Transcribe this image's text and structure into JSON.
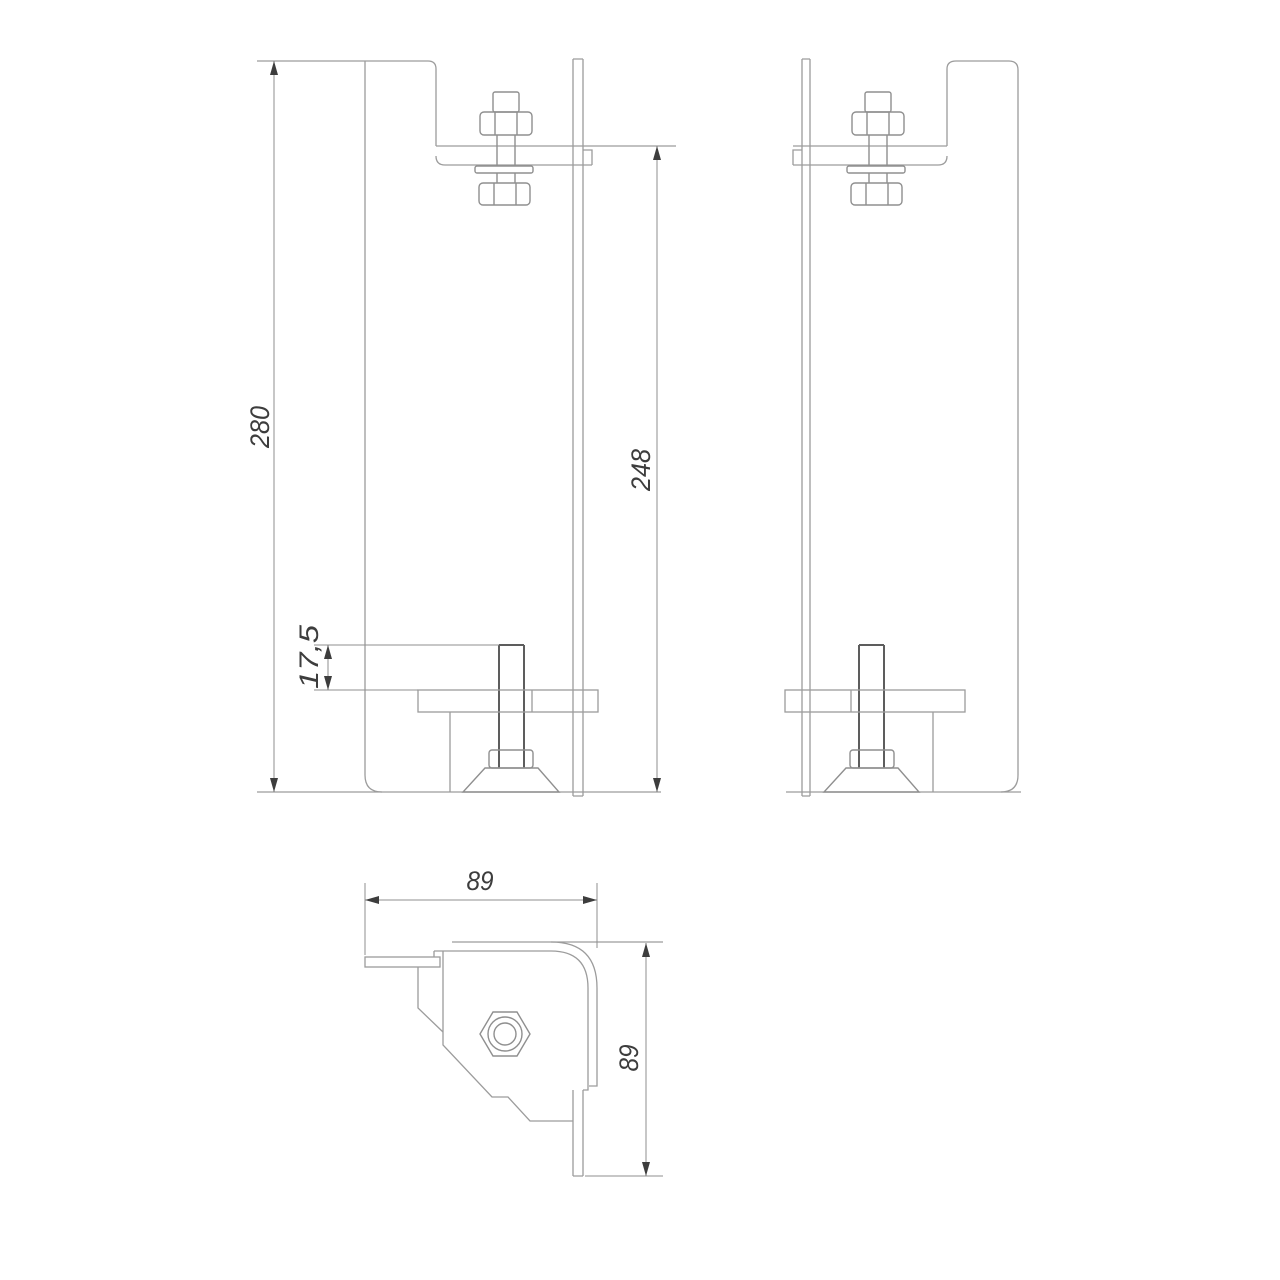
{
  "drawing": {
    "type": "technical-drawing-bracket",
    "dimensions": {
      "overall_height": "280",
      "bracket_height": "248",
      "stud_protrusion": "17,5",
      "width": "89",
      "depth": "89"
    },
    "colors": {
      "background": "#ffffff",
      "part_line": "#9c9c9c",
      "stud_line": "#5d5d5d",
      "dimension_line": "#8f8f8f",
      "annotation": "#3d3d3d"
    }
  }
}
